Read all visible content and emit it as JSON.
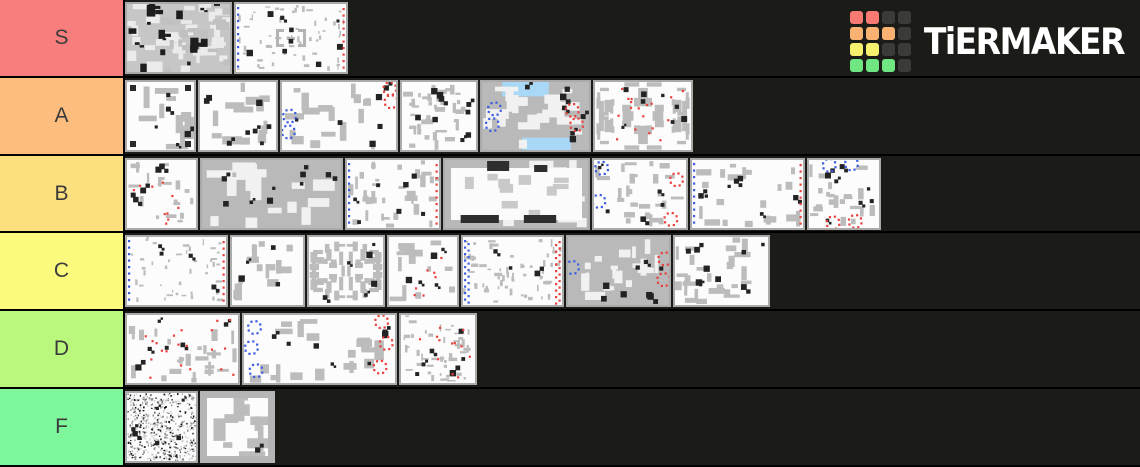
{
  "page": {
    "background": "#1b1b17",
    "divider_color": "#000000",
    "label_text_color": "#3b3b3b"
  },
  "logo": {
    "text": "TiERMAKER",
    "grid": [
      "red",
      "red",
      "dark",
      "dark",
      "orange",
      "orange",
      "orange",
      "dark",
      "yellow",
      "yellow",
      "dark",
      "dark",
      "green",
      "green",
      "green",
      "dark"
    ],
    "colors": {
      "red": "#f87a72",
      "orange": "#f8b271",
      "yellow": "#f6f06e",
      "green": "#70e683",
      "dark": "#3b3b38"
    }
  },
  "map_palette": {
    "wall": "#bcbcbc",
    "blue_dot": "#3c5ce0",
    "red_dot": "#e8403c",
    "sky": "#a9d7f6",
    "black": "#232323",
    "frame": "#aaaaaa"
  },
  "tiers": [
    {
      "label": "S",
      "color": "#f87e7e",
      "items": [
        {
          "w": 107,
          "seed": 11,
          "chaos": true
        },
        {
          "w": 114,
          "seed": 12,
          "wallN": 60,
          "chunk": 2,
          "black": 9,
          "blueEdge": true,
          "redEdge": true,
          "bracket": true
        }
      ]
    },
    {
      "label": "A",
      "color": "#fcbd7e",
      "items": [
        {
          "w": 71,
          "seed": 21,
          "wallN": 10,
          "chunk": 7,
          "black": 5,
          "corners": true
        },
        {
          "w": 80,
          "seed": 22,
          "wallN": 14,
          "chunk": 6,
          "black": 8
        },
        {
          "w": 118,
          "seed": 23,
          "wallN": 17,
          "chunk": 6,
          "black": 6,
          "blueClusters": [
            [
              0.08,
              0.5
            ],
            [
              0.07,
              0.72
            ]
          ],
          "redClusters": [
            [
              0.93,
              0.12
            ],
            [
              0.94,
              0.3
            ]
          ]
        },
        {
          "w": 78,
          "seed": 24,
          "wallN": 40,
          "chunk": 3.5,
          "black": 9
        },
        {
          "w": 111,
          "seed": 25,
          "bg": "gray",
          "wallN": 22,
          "chunk": 7,
          "black": 7,
          "sky": true,
          "blueClusters": [
            [
              0.13,
              0.4
            ],
            [
              0.11,
              0.62
            ]
          ],
          "redClusters": [
            [
              0.83,
              0.42
            ],
            [
              0.87,
              0.62
            ]
          ]
        },
        {
          "w": 100,
          "seed": 26,
          "wallN": 14,
          "chunk": 5,
          "sym": "quad",
          "black": 8,
          "redScatter": 18
        }
      ]
    },
    {
      "label": "B",
      "color": "#fcdf7e",
      "items": [
        {
          "w": 73,
          "seed": 31,
          "wallN": 18,
          "chunk": 3.5,
          "black": 5,
          "redScatter": 10
        },
        {
          "w": 143,
          "seed": 32,
          "bg": "gray",
          "wallN": 16,
          "chunk": 9,
          "black": 10
        },
        {
          "w": 96,
          "seed": 33,
          "wallN": 34,
          "chunk": 4,
          "black": 7,
          "blueEdge": true,
          "redEdge": true
        },
        {
          "w": 147,
          "seed": 34,
          "bg": "gray",
          "wallN": 10,
          "chunk": 8,
          "darkBars": true
        },
        {
          "w": 96,
          "seed": 35,
          "wallN": 26,
          "chunk": 4,
          "black": 6,
          "blueClusters": [
            [
              0.1,
              0.14
            ],
            [
              0.07,
              0.6
            ]
          ],
          "redClusters": [
            [
              0.88,
              0.3
            ],
            [
              0.82,
              0.85
            ]
          ]
        },
        {
          "w": 115,
          "seed": 36,
          "wallN": 20,
          "chunk": 5,
          "black": 7,
          "blueEdge": true,
          "redEdge": true
        },
        {
          "w": 74,
          "seed": 37,
          "wallN": 22,
          "chunk": 4,
          "black": 7,
          "blueClusters": [
            [
              0.3,
              0.1
            ],
            [
              0.6,
              0.08
            ]
          ],
          "redClusters": [
            [
              0.35,
              0.9
            ],
            [
              0.65,
              0.88
            ]
          ]
        }
      ]
    },
    {
      "label": "C",
      "color": "#fbfa7d",
      "items": [
        {
          "w": 103,
          "seed": 41,
          "wallN": 42,
          "chunk": 2,
          "black": 4,
          "blueEdge": true,
          "redEdge": true
        },
        {
          "w": 75,
          "seed": 42,
          "wallN": 14,
          "chunk": 5.5,
          "black": 4
        },
        {
          "w": 78,
          "seed": 43,
          "wallN": 16,
          "chunk": 4.5,
          "sym": "quad",
          "black": 6
        },
        {
          "w": 72,
          "seed": 44,
          "wallN": 14,
          "chunk": 5,
          "black": 5,
          "redScatter": 7
        },
        {
          "w": 103,
          "seed": 45,
          "wallN": 60,
          "chunk": 2.5,
          "black": 3,
          "blueEdge": "thick",
          "redEdge": "thick"
        },
        {
          "w": 105,
          "seed": 46,
          "bg": "gray",
          "wallN": 18,
          "chunk": 6,
          "black": 8,
          "blueClusters": [
            [
              0.06,
              0.45
            ]
          ],
          "redClusters": [
            [
              0.94,
              0.33
            ],
            [
              0.93,
              0.62
            ]
          ]
        },
        {
          "w": 97,
          "seed": 47,
          "wallN": 26,
          "chunk": 5,
          "black": 9
        }
      ]
    },
    {
      "label": "D",
      "color": "#baf87d",
      "items": [
        {
          "w": 115,
          "seed": 51,
          "wallN": 26,
          "chunk": 4.5,
          "black": 6,
          "redScatter": 20
        },
        {
          "w": 155,
          "seed": 52,
          "wallN": 20,
          "chunk": 7,
          "black": 8,
          "blueClusters": [
            [
              0.08,
              0.2
            ],
            [
              0.06,
              0.48
            ],
            [
              0.09,
              0.8
            ]
          ],
          "redClusters": [
            [
              0.9,
              0.12
            ],
            [
              0.93,
              0.42
            ],
            [
              0.89,
              0.75
            ]
          ]
        },
        {
          "w": 78,
          "seed": 53,
          "wallN": 45,
          "chunk": 2.5,
          "black": 6,
          "redScatter": 12
        }
      ]
    },
    {
      "label": "F",
      "color": "#7ef79c",
      "items": [
        {
          "w": 73,
          "seed": 61,
          "noise": true,
          "black": 6
        },
        {
          "w": 75,
          "seed": 62,
          "wallN": 11,
          "chunk": 9,
          "black": 1,
          "thickFrame": true
        }
      ]
    }
  ]
}
